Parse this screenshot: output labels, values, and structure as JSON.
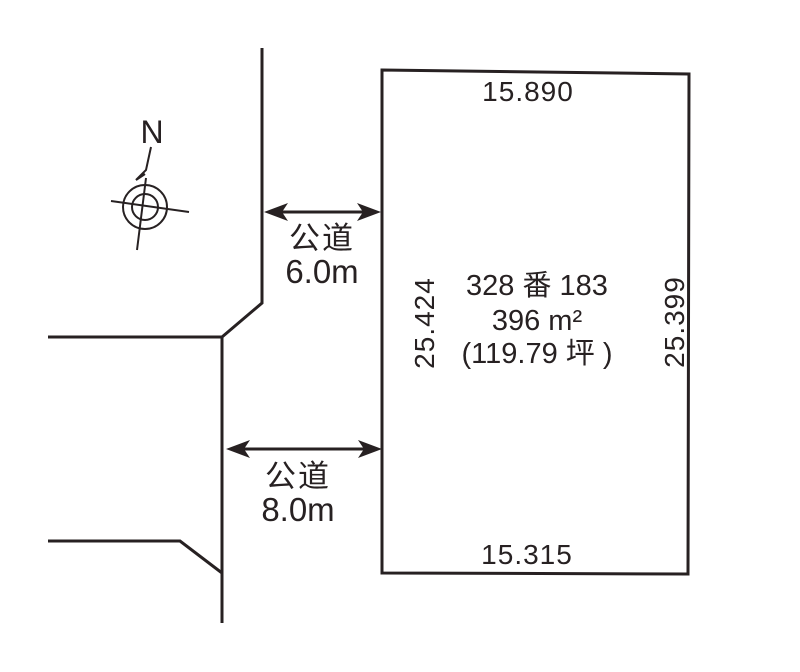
{
  "colors": {
    "background": "#ffffff",
    "ink": "#272122"
  },
  "compass": {
    "north_label": "N"
  },
  "plot": {
    "lot_number": "328 番 183",
    "area_sqm": "396 m²",
    "area_tsubo": "(119.79 坪 )",
    "dim_top": "15.890",
    "dim_bottom": "15.315",
    "dim_left": "25.424",
    "dim_right": "25.399"
  },
  "roads": {
    "upper": {
      "label": "公道",
      "width": "6.0m"
    },
    "lower": {
      "label": "公道",
      "width": "8.0m"
    }
  }
}
